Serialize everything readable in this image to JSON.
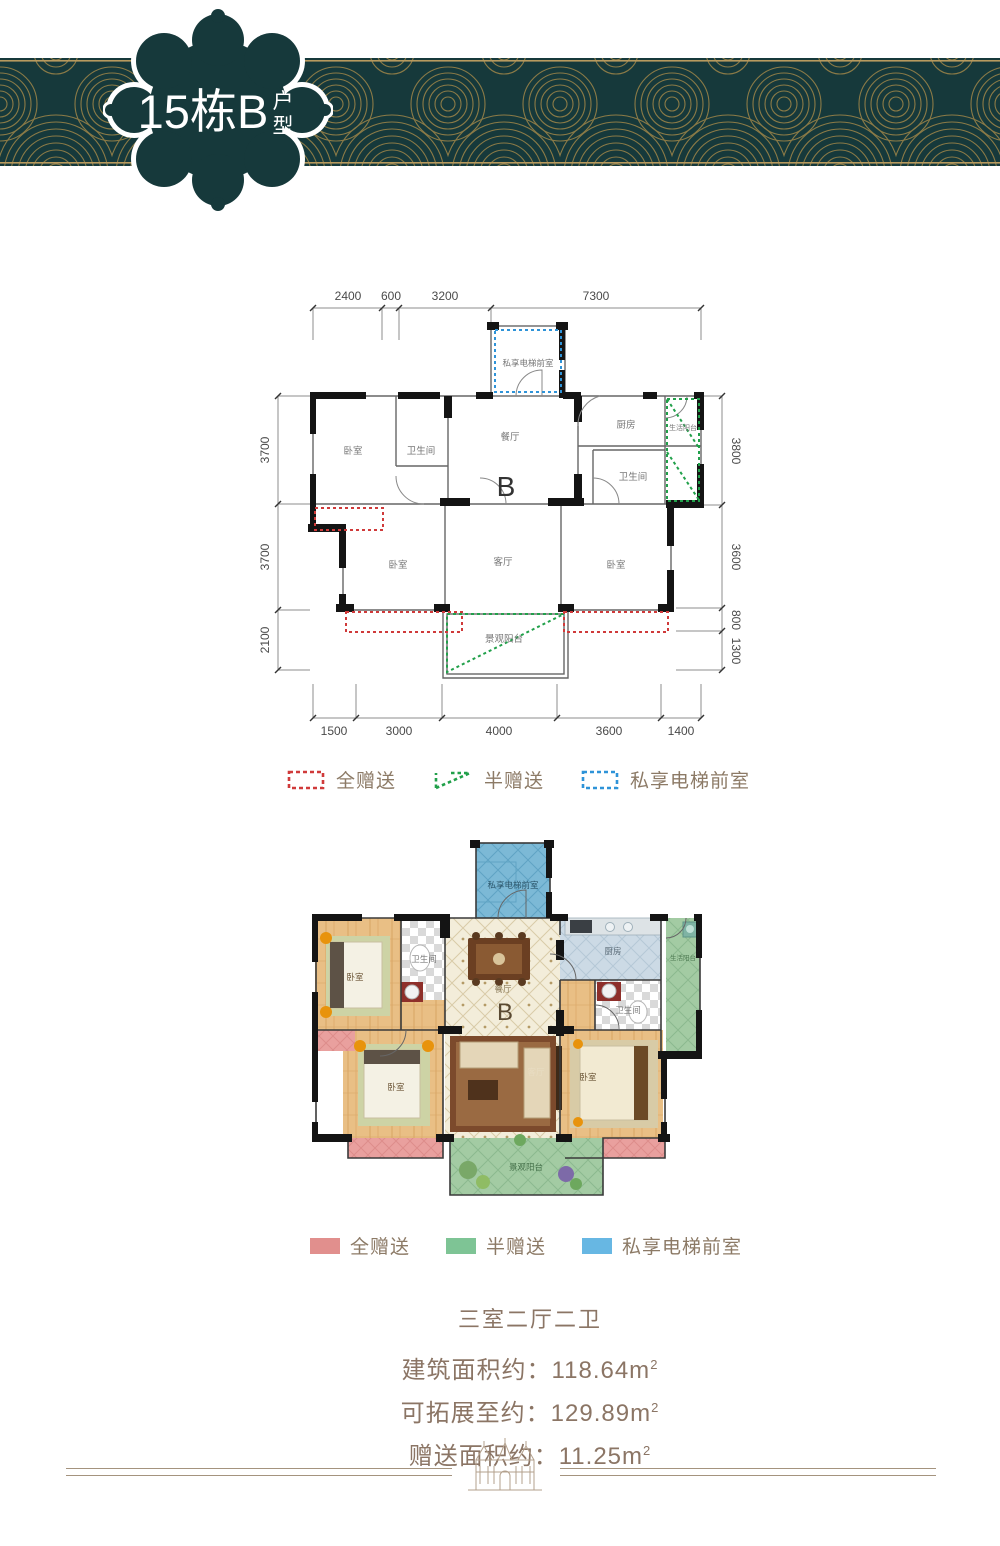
{
  "badge": {
    "title": "15栋B",
    "suffix_chars": [
      "户",
      "型"
    ]
  },
  "banner": {
    "teal": "#16393b",
    "gold": "#a08648"
  },
  "plan1": {
    "dims_top": [
      "2400",
      "600",
      "3200",
      "7300"
    ],
    "dims_left": [
      "3700",
      "3700",
      "2100"
    ],
    "dims_right": [
      "3800",
      "3600",
      "800",
      "1300"
    ],
    "dims_bottom": [
      "1500",
      "3000",
      "4000",
      "3600",
      "1400"
    ],
    "rooms": {
      "elevator": "私享电梯前室",
      "bedroom": "卧室",
      "bath": "卫生间",
      "dining": "餐厅",
      "kitchen": "厨房",
      "life_balcony": "生活阳台",
      "living": "客厅",
      "view_balcony": "景观阳台",
      "type_letter": "B"
    }
  },
  "legend_dashed": {
    "items": [
      {
        "label": "全赠送",
        "color": "#d03a3a"
      },
      {
        "label": "半赠送",
        "color": "#21a04a"
      },
      {
        "label": "私享电梯前室",
        "color": "#2e93d8"
      }
    ]
  },
  "plan2": {
    "rooms": {
      "elevator": "私享电梯前室",
      "bedroom": "卧室",
      "bath": "卫生间",
      "dining": "餐厅",
      "kitchen": "厨房",
      "life_balcony": "生活阳台",
      "living": "客厅",
      "view_balcony": "景观阳台",
      "type_letter": "B"
    }
  },
  "legend_solid": {
    "items": [
      {
        "label": "全赠送",
        "color": "#e18f8d"
      },
      {
        "label": "半赠送",
        "color": "#7ec495"
      },
      {
        "label": "私享电梯前室",
        "color": "#67b7e3"
      }
    ]
  },
  "summary": {
    "title": "三室二厅二卫",
    "lines": [
      {
        "label": "建筑面积约：118.64m",
        "sup": "2"
      },
      {
        "label": "可拓展至约：129.89m",
        "sup": "2"
      },
      {
        "label": "赠送面积约：11.25m",
        "sup": "2"
      }
    ]
  }
}
